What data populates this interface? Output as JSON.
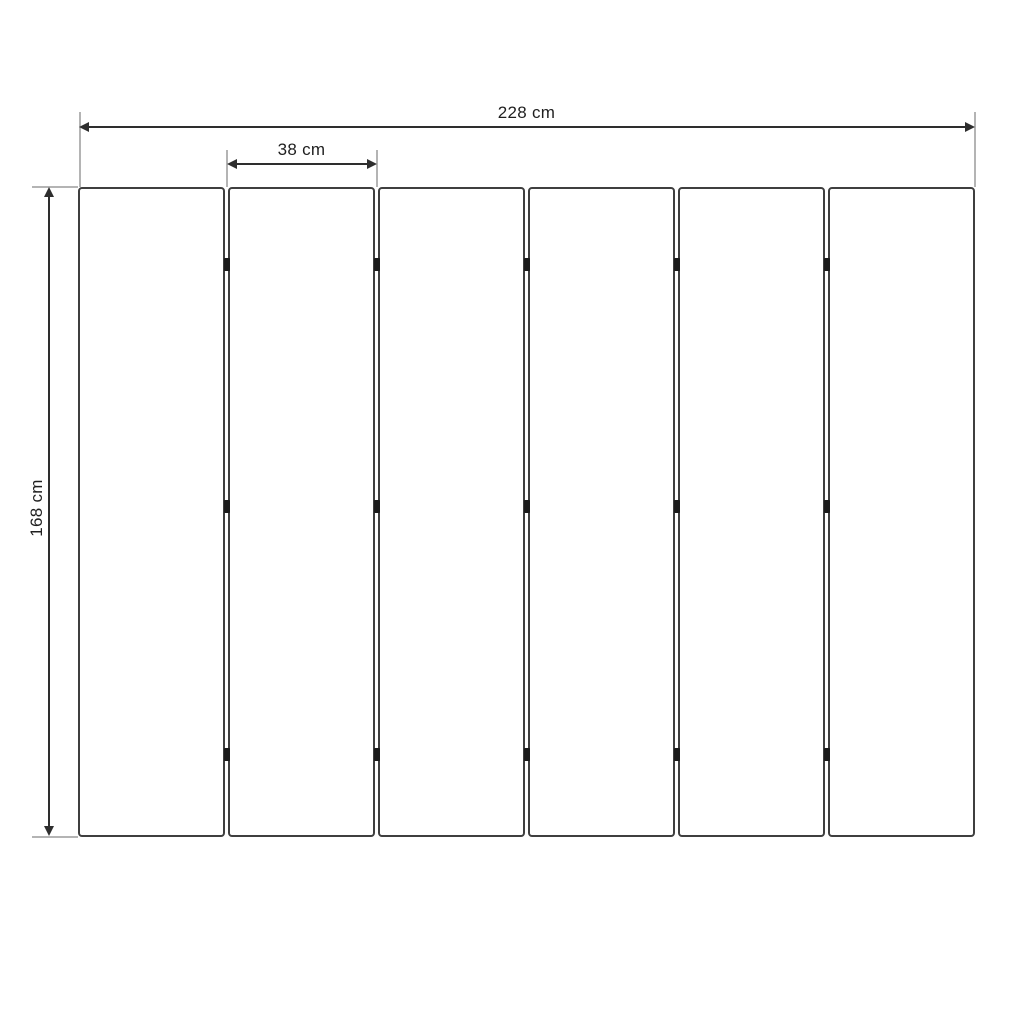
{
  "diagram": {
    "kind": "panel-dimension-drawing",
    "labels": {
      "total_width": "228 cm",
      "panel_width": "38 cm",
      "height": "168 cm"
    },
    "values": {
      "total_width_cm": 228,
      "panel_width_cm": 38,
      "height_cm": 168,
      "panel_count": 6,
      "gap_count": 5,
      "hinge_rows": 3
    },
    "colors": {
      "background": "#ffffff",
      "panel_border": "#3f3f3f",
      "panel_fill": "#ffffff",
      "dimension_line": "#2e2e2e",
      "extension_line": "#b4b4b4",
      "hinge": "#1b1b1b",
      "text": "#1f1f1f"
    }
  }
}
